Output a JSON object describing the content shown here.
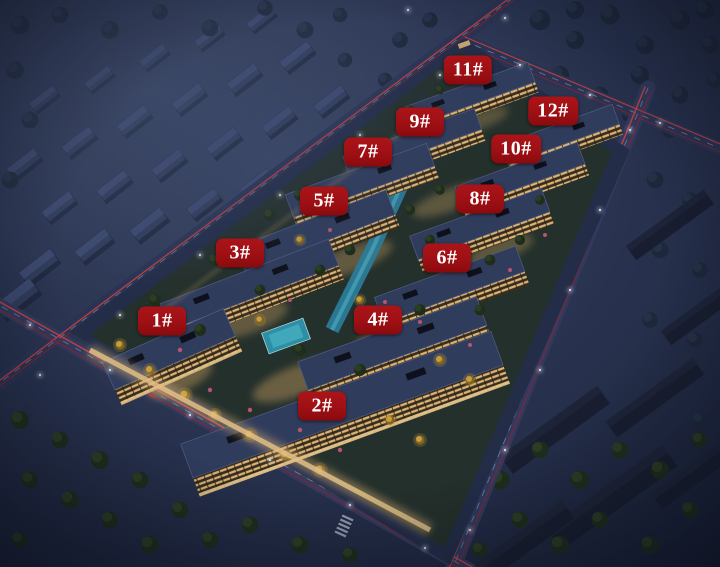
{
  "map": {
    "kind": "night-aerial-residential-rendering",
    "colors": {
      "badge_bg": "#9e1014",
      "badge_text": "#ffffff",
      "night_base": "#1a2238",
      "roof_blue": "#323e5e",
      "window_warm": "#f0c27b",
      "road": "#2b3454",
      "light_trail_red": "#e8453e",
      "water_teal": "#2f8da6",
      "tree_green": "#1f2d17",
      "tree_gold": "#d9a93c"
    },
    "markers": [
      {
        "label": "1#",
        "x": 162,
        "y": 321
      },
      {
        "label": "2#",
        "x": 322,
        "y": 406
      },
      {
        "label": "3#",
        "x": 240,
        "y": 253
      },
      {
        "label": "4#",
        "x": 378,
        "y": 320
      },
      {
        "label": "5#",
        "x": 324,
        "y": 201
      },
      {
        "label": "6#",
        "x": 447,
        "y": 258
      },
      {
        "label": "7#",
        "x": 368,
        "y": 152
      },
      {
        "label": "8#",
        "x": 480,
        "y": 199
      },
      {
        "label": "9#",
        "x": 420,
        "y": 122
      },
      {
        "label": "10#",
        "x": 516,
        "y": 149
      },
      {
        "label": "11#",
        "x": 468,
        "y": 70
      },
      {
        "label": "12#",
        "x": 553,
        "y": 111
      }
    ]
  }
}
